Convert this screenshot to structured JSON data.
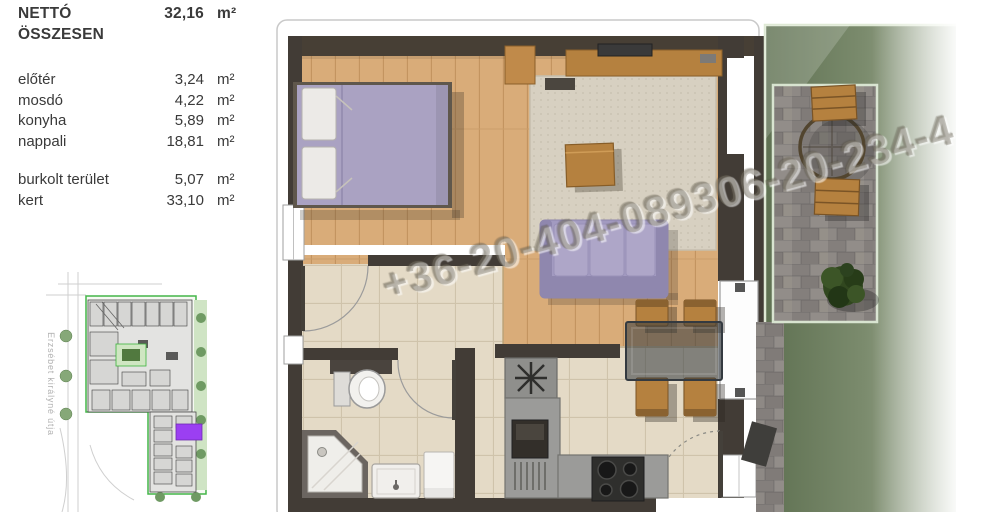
{
  "area_table": {
    "header": {
      "label": "NETTÓ ÖSSZESEN",
      "value": "32,16",
      "unit": "m²"
    },
    "rooms": [
      {
        "label": "előtér",
        "value": "3,24",
        "unit": "m²"
      },
      {
        "label": "mosdó",
        "value": "4,22",
        "unit": "m²"
      },
      {
        "label": "konyha",
        "value": "5,89",
        "unit": "m²"
      },
      {
        "label": "nappali",
        "value": "18,81",
        "unit": "m²"
      }
    ],
    "outdoor": [
      {
        "label": "burkolt terület",
        "value": "5,07",
        "unit": "m²"
      },
      {
        "label": "kert",
        "value": "33,10",
        "unit": "m²"
      }
    ]
  },
  "site_plan": {
    "street_label": "Erzsébet királyné útja"
  },
  "watermark": {
    "text": "+36-20-404-089306-20-234-4"
  },
  "colors": {
    "furniture_purple": "#aaa2c2",
    "furniture_purple_dark": "#8f87ae",
    "wood_floor": "#d9ac79",
    "tile_floor": "#e4dac6",
    "wall_dark": "#423c36",
    "counter_gray": "#9b9b99",
    "paver_gray": "#8b8683",
    "furniture_wood": "#b5813f",
    "rug_beige": "#d7d0c1",
    "grass_green": "#6e7f5c",
    "site_outline_green": "#44b649",
    "site_highlight_purple": "#9b3ff2"
  }
}
